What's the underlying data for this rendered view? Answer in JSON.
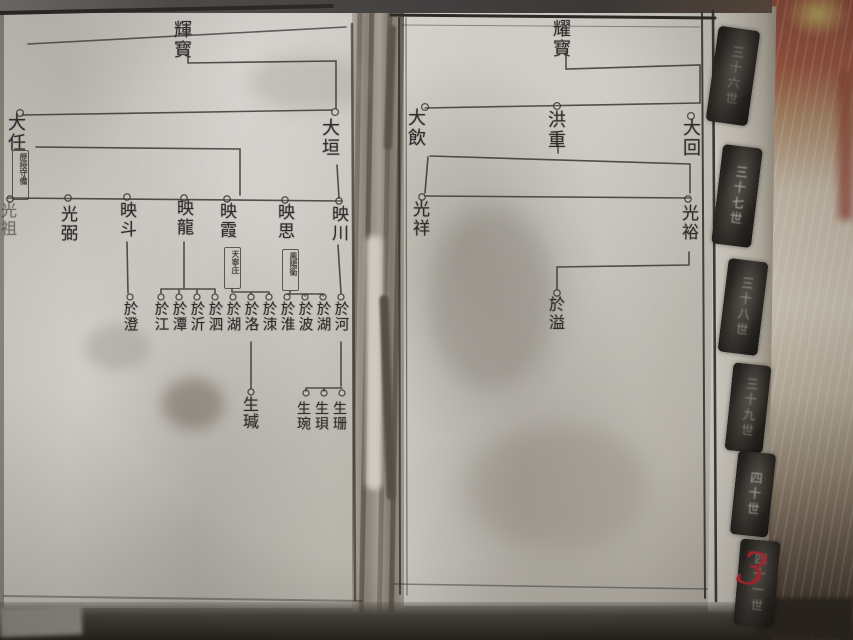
{
  "left_page": {
    "ancestor": "輝寳",
    "gen37": [
      "大任",
      "大垣"
    ],
    "gen37_note": "歷授守備",
    "gen38": [
      "光祖",
      "光弼",
      "映斗",
      "映龍",
      "映霞",
      "映思",
      "映川"
    ],
    "gen38_note_yingxia": "天寧庄",
    "gen38_note_yingsi": "鳳陽衛",
    "gen39": [
      "於澄",
      "於江",
      "於潭",
      "於沂",
      "於泗",
      "於湖",
      "於洛",
      "於洓",
      "於淮",
      "於波",
      "於湖",
      "於河"
    ],
    "gen40": [
      "生瑊",
      "生琬",
      "生珼",
      "生珊"
    ]
  },
  "right_page": {
    "ancestor": "耀寳",
    "gen37": [
      "大飲",
      "洪重",
      "大回"
    ],
    "gen38": [
      "光祥",
      "光裕"
    ],
    "gen39": [
      "於溢"
    ]
  },
  "side_tabs": [
    "三十六世",
    "三十七世",
    "三十八世",
    "三十九世",
    "四十世",
    "四十一世"
  ],
  "handwritten_page_number": "3"
}
